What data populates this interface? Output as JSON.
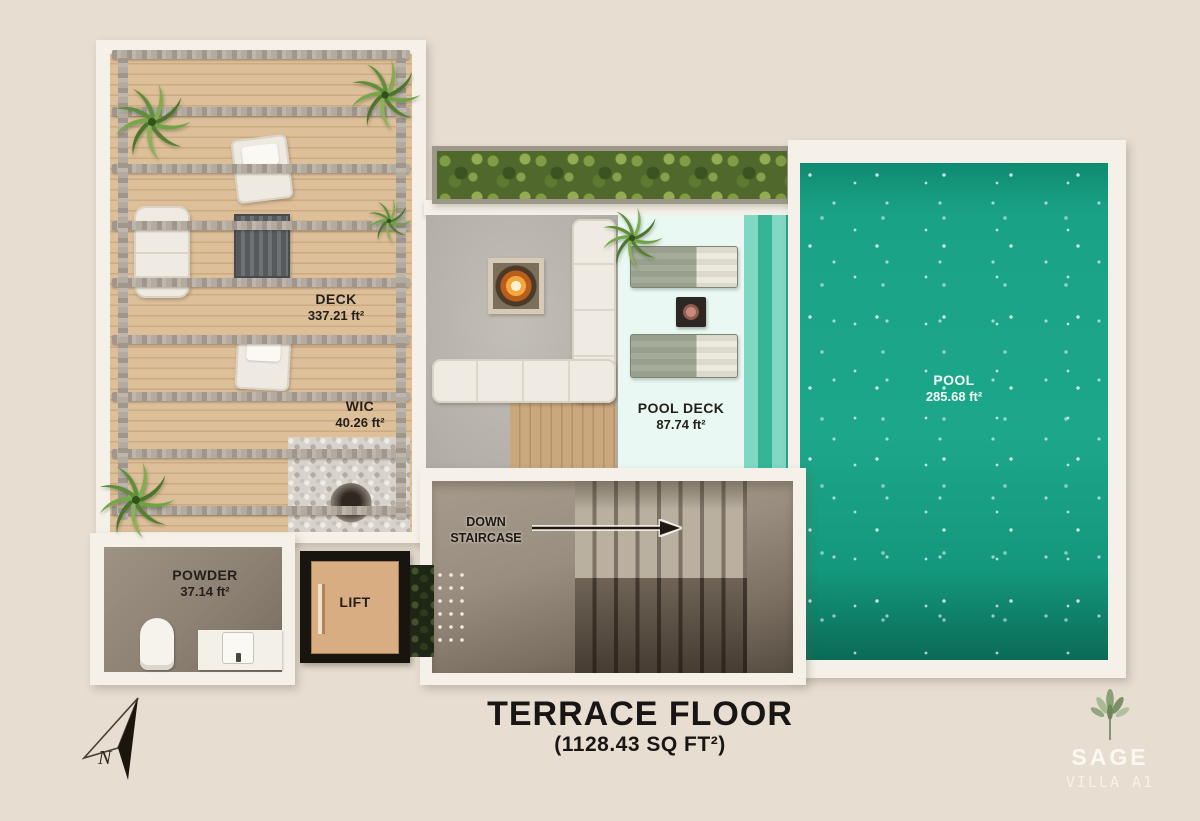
{
  "title": {
    "main": "TERRACE FLOOR",
    "area": "(1128.43 SQ FT²)"
  },
  "rooms": {
    "deck": {
      "name": "DECK",
      "area": "337.21 ft²"
    },
    "wic": {
      "name": "WIC",
      "area": "40.26 ft²"
    },
    "pool_deck": {
      "name": "POOL DECK",
      "area": "87.74 ft²"
    },
    "pool": {
      "name": "POOL",
      "area": "285.68 ft²"
    },
    "powder": {
      "name": "POWDER",
      "area": "37.14 ft²"
    },
    "lift": {
      "name": "LIFT"
    },
    "staircase": {
      "line1": "DOWN",
      "line2": "STAIRCASE"
    }
  },
  "compass": {
    "label": "N"
  },
  "brand": {
    "name": "SAGE",
    "unit": "VILLA A1"
  },
  "colors": {
    "background": "#e7ddd1",
    "wall": "#f5f1e9",
    "wood_deck": "#ddbf9a",
    "concrete": "#b9b5ae",
    "pool_water": "#1ba185",
    "pool_deck": "#e9f8f2",
    "stair_room": "#9a8e80",
    "lift_floor": "#d7ad81",
    "label_text": "#241f1a"
  }
}
